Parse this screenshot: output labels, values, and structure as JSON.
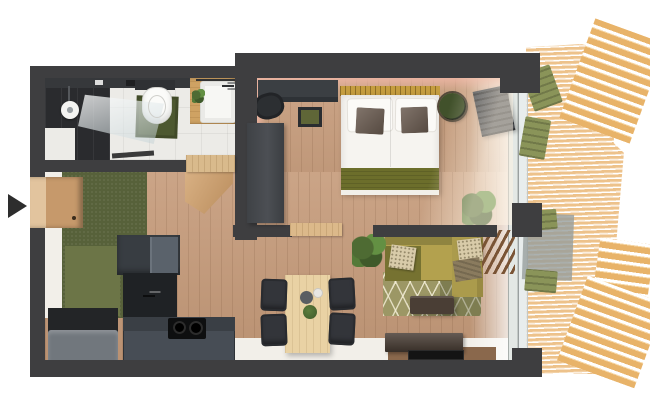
{
  "meta": {
    "kind": "3d-rendered-apartment-floor-plan-top-view",
    "description": "Top-down 3D render of a one-bedroom apartment floor plan with bathroom, bedroom, kitchen, living-dining area and slatted wood balcony; entrance arrow on the left",
    "canvas": {
      "width": 650,
      "height": 420
    }
  },
  "entrance": {
    "indicator": "arrow-right",
    "color": "#2d2d2d"
  },
  "palette": {
    "wall": "#3e3e40",
    "wood": "#c59a79",
    "bath_floor": "#ecebe7",
    "white_floor": "#f2efe9",
    "green_panel": "#57613a",
    "green_mat": "#4d5830",
    "sofa": "#b3a14e",
    "sofa_dark": "#767231",
    "rug": "#9c9765",
    "blanket": "#6c6e2b",
    "bed_white": "#f6f4f0",
    "pillow_cushion": "#6b5c51",
    "headboard": "#c59d3f",
    "kitchen_dark": "#383d42",
    "kitchen_gray": "#474d55",
    "counter_dark": "#1f2225",
    "bench_gray": "#71777d",
    "table_wood": "#e9d2a4",
    "chair_dark": "#33353a",
    "deck_wood": "#edc28b",
    "awning_wood": "#e8b369",
    "lounger_green": "#8a9459",
    "console_brown": "#4a3e35",
    "mat_brown": "#8a684c",
    "pink_accent": "#e9b3a0",
    "glass": "#e3e8e5",
    "plant_green": "#4e6b33",
    "arrow": "#2d2d2d"
  },
  "rooms": [
    {
      "id": "bathroom",
      "items": [
        "dark-tiled-shower",
        "shower-head",
        "glass-screen",
        "toilet",
        "green-bath-mat",
        "wood-vanity",
        "white-sink",
        "small-plant",
        "open-door"
      ]
    },
    {
      "id": "bedroom",
      "items": [
        "double-bed",
        "two-pillows",
        "two-dark-cushions",
        "olive-blanket",
        "gold-headboard",
        "desk",
        "desk-chair",
        "stool",
        "tall-wardrobe",
        "round-side-table",
        "open-balcony-door",
        "potted-plant",
        "pink-accent-wall"
      ]
    },
    {
      "id": "kitchen",
      "items": [
        "l-shaped-dark-kitchen-unit",
        "cooktop-two-burners",
        "sink-faucet",
        "green-felt-wall",
        "gray-bench",
        "wood-entrance-door"
      ]
    },
    {
      "id": "living-dining",
      "items": [
        "dining-table",
        "four-dark-chairs",
        "table-decor",
        "corner-sofa-olive",
        "patterned-rug",
        "coffee-table",
        "tv-console",
        "tv-on-mat",
        "two-potted-plants",
        "slatted-screen"
      ]
    },
    {
      "id": "balcony",
      "items": [
        "slatted-wood-deck",
        "glass-balustrade",
        "green-loungers",
        "gray-mat",
        "slatted-awnings",
        "wall-stubs"
      ]
    }
  ]
}
